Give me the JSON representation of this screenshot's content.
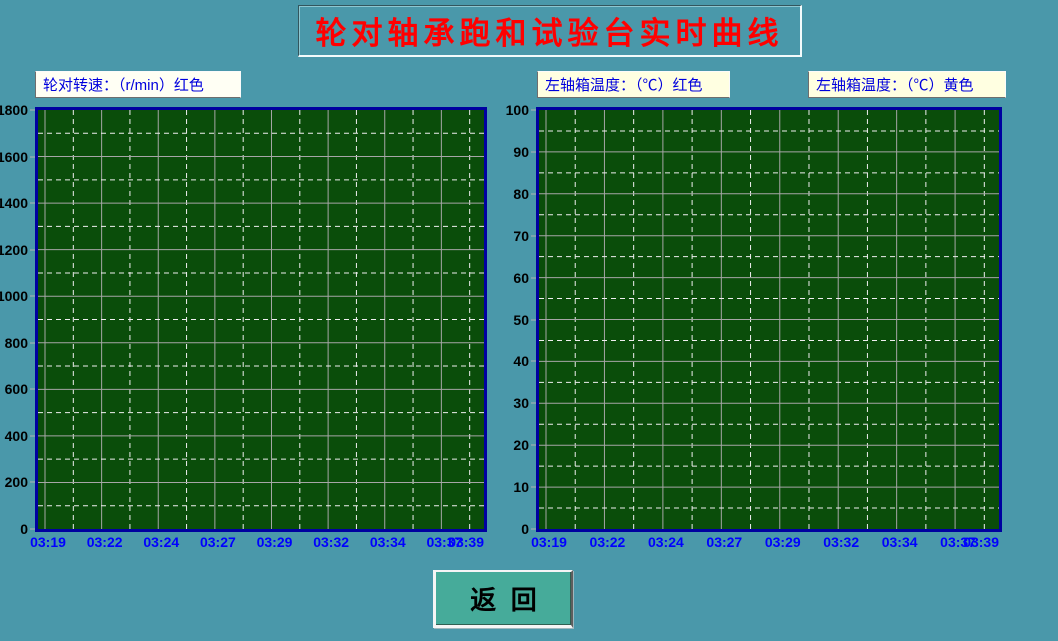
{
  "page": {
    "title": "轮对轴承跑和试验台实时曲线",
    "back_button": "返  回"
  },
  "colors": {
    "background": "#4a98aa",
    "title_text": "#ff0000",
    "plot_background": "#0a4d0a",
    "plot_border": "#0000a0",
    "grid_major": "#a6a6a6",
    "grid_minor": "#efefef",
    "x_label_text": "#0000ff",
    "y_label_text": "#000000",
    "legend_text": "#0000dd",
    "legend_bg_speed": "#fffff4",
    "legend_bg_temp": "#ffffe1",
    "button_bg": "#46ab9a"
  },
  "chart_data": [
    {
      "type": "line",
      "legend": "轮对转速：（r/min）红色",
      "y_axis": {
        "min": 0,
        "max": 1800,
        "major_step": 200,
        "minor_step": 100,
        "tick_labels": [
          "1800",
          "1600",
          "1400",
          "1200",
          "1000",
          "800",
          "600",
          "400",
          "200",
          "0"
        ]
      },
      "x_labels": [
        "03:19",
        "03:22",
        "03:24",
        "03:27",
        "03:29",
        "03:32",
        "03:34",
        "03:37",
        "03:39"
      ],
      "x_range": [
        "03:19",
        "03:39"
      ],
      "series": [
        {
          "name": "轮对转速",
          "unit": "r/min",
          "color": "#ff0000",
          "values": []
        }
      ],
      "grid": {
        "major": "solid",
        "minor": "dashed"
      }
    },
    {
      "type": "line",
      "legends": [
        "左轴箱温度：（℃）红色",
        "左轴箱温度：（℃）黄色"
      ],
      "y_axis": {
        "min": 0,
        "max": 100,
        "major_step": 10,
        "minor_step": 5,
        "tick_labels": [
          "100",
          "90",
          "80",
          "70",
          "60",
          "50",
          "40",
          "30",
          "20",
          "10",
          "0"
        ]
      },
      "x_labels": [
        "03:19",
        "03:22",
        "03:24",
        "03:27",
        "03:29",
        "03:32",
        "03:34",
        "03:37",
        "03:39"
      ],
      "x_range": [
        "03:19",
        "03:39"
      ],
      "series": [
        {
          "name": "左轴箱温度（红）",
          "unit": "℃",
          "color": "#ff0000",
          "values": []
        },
        {
          "name": "左轴箱温度（黄）",
          "unit": "℃",
          "color": "#ffff00",
          "values": []
        }
      ],
      "grid": {
        "major": "solid",
        "minor": "dashed"
      }
    }
  ]
}
